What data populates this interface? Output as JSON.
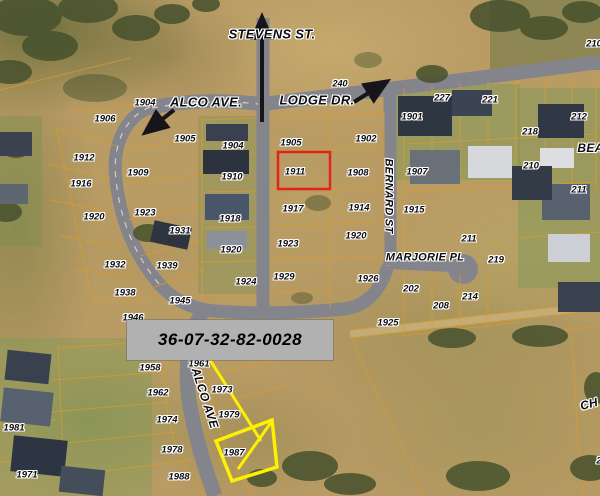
{
  "annotations": {
    "parcel_id": "36-07-32-82-0028",
    "highlighted_parcel": "1911"
  },
  "colors": {
    "highlight_red": "#e1251b",
    "annotation_yellow": "#fdf000",
    "id_box_bg": "#b1b1b1",
    "id_box_text": "#000000",
    "road_gray": "#84848c",
    "parcel_line_orange": "#d99b2d",
    "label_text": "#0b0b10",
    "label_halo": "#ffffff"
  },
  "street_labels": [
    {
      "text": "STEVENS ST.",
      "x": 272,
      "y": 34,
      "size": 13
    },
    {
      "text": "ALCO AVE.",
      "x": 206,
      "y": 102,
      "size": 13
    },
    {
      "text": "LODGE DR.",
      "x": 317,
      "y": 100,
      "size": 13
    },
    {
      "text": "BERNARD ST",
      "x": 388,
      "y": 196,
      "size": 11,
      "rotate": 90
    },
    {
      "text": "MARJORIE PL",
      "x": 425,
      "y": 258,
      "size": 11
    },
    {
      "text": "ALCO AVE",
      "x": 205,
      "y": 398,
      "size": 12,
      "rotate": 72
    },
    {
      "text": "BEAN",
      "x": 595,
      "y": 148,
      "size": 12
    },
    {
      "text": "CH",
      "x": 589,
      "y": 404,
      "size": 12,
      "rotate": -15
    }
  ],
  "parcel_labels": [
    {
      "text": "240",
      "x": 340,
      "y": 84,
      "size": 9
    },
    {
      "text": "227",
      "x": 442,
      "y": 98
    },
    {
      "text": "221",
      "x": 490,
      "y": 100
    },
    {
      "text": "210",
      "x": 594,
      "y": 44
    },
    {
      "text": "212",
      "x": 579,
      "y": 117
    },
    {
      "text": "218",
      "x": 530,
      "y": 132
    },
    {
      "text": "210",
      "x": 531,
      "y": 166
    },
    {
      "text": "211",
      "x": 579,
      "y": 190
    },
    {
      "text": "1901",
      "x": 412,
      "y": 117
    },
    {
      "text": "1907",
      "x": 417,
      "y": 172
    },
    {
      "text": "1915",
      "x": 414,
      "y": 210
    },
    {
      "text": "211",
      "x": 469,
      "y": 239
    },
    {
      "text": "219",
      "x": 496,
      "y": 260
    },
    {
      "text": "202",
      "x": 411,
      "y": 289
    },
    {
      "text": "214",
      "x": 470,
      "y": 297
    },
    {
      "text": "208",
      "x": 441,
      "y": 306
    },
    {
      "text": "1925",
      "x": 388,
      "y": 323
    },
    {
      "text": "1902",
      "x": 366,
      "y": 139
    },
    {
      "text": "1908",
      "x": 358,
      "y": 173
    },
    {
      "text": "1914",
      "x": 359,
      "y": 208
    },
    {
      "text": "1920",
      "x": 356,
      "y": 236
    },
    {
      "text": "1926",
      "x": 368,
      "y": 279
    },
    {
      "text": "1905",
      "x": 291,
      "y": 143
    },
    {
      "text": "1911",
      "x": 295,
      "y": 172
    },
    {
      "text": "1917",
      "x": 293,
      "y": 209
    },
    {
      "text": "1923",
      "x": 288,
      "y": 244
    },
    {
      "text": "1929",
      "x": 284,
      "y": 277
    },
    {
      "text": "1904",
      "x": 233,
      "y": 146
    },
    {
      "text": "1910",
      "x": 232,
      "y": 177
    },
    {
      "text": "1918",
      "x": 230,
      "y": 219
    },
    {
      "text": "1920",
      "x": 231,
      "y": 250
    },
    {
      "text": "1924",
      "x": 246,
      "y": 282
    },
    {
      "text": "1904",
      "x": 145,
      "y": 103
    },
    {
      "text": "1906",
      "x": 105,
      "y": 119
    },
    {
      "text": "1912",
      "x": 84,
      "y": 158
    },
    {
      "text": "1916",
      "x": 81,
      "y": 184
    },
    {
      "text": "1920",
      "x": 94,
      "y": 217
    },
    {
      "text": "1905",
      "x": 185,
      "y": 139
    },
    {
      "text": "1909",
      "x": 138,
      "y": 173
    },
    {
      "text": "1923",
      "x": 145,
      "y": 213
    },
    {
      "text": "1931",
      "x": 180,
      "y": 231
    },
    {
      "text": "1932",
      "x": 115,
      "y": 265
    },
    {
      "text": "1939",
      "x": 167,
      "y": 266
    },
    {
      "text": "1938",
      "x": 125,
      "y": 293
    },
    {
      "text": "1945",
      "x": 180,
      "y": 301
    },
    {
      "text": "1946",
      "x": 133,
      "y": 318
    },
    {
      "text": "1958",
      "x": 150,
      "y": 368
    },
    {
      "text": "1961",
      "x": 199,
      "y": 364
    },
    {
      "text": "1962",
      "x": 158,
      "y": 393
    },
    {
      "text": "1973",
      "x": 222,
      "y": 390
    },
    {
      "text": "1974",
      "x": 167,
      "y": 420
    },
    {
      "text": "1979",
      "x": 229,
      "y": 415
    },
    {
      "text": "1978",
      "x": 172,
      "y": 450
    },
    {
      "text": "1987",
      "x": 234,
      "y": 453
    },
    {
      "text": "1988",
      "x": 179,
      "y": 477
    },
    {
      "text": "1981",
      "x": 14,
      "y": 428
    },
    {
      "text": "1971",
      "x": 27,
      "y": 475
    },
    {
      "text": "2",
      "x": 599,
      "y": 461
    }
  ]
}
